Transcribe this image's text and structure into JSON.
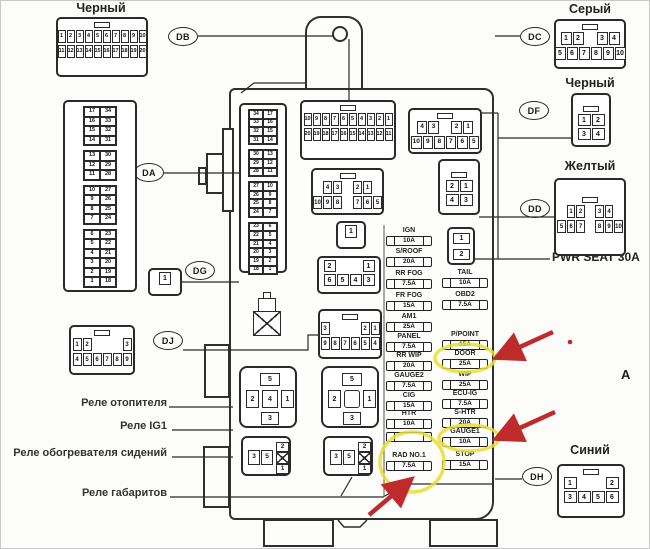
{
  "titles": {
    "top_left_connector": "Черный",
    "dc_connector": "Серый",
    "df_connector": "Черный",
    "dd_connector": "Желтый",
    "dh_connector": "Синий"
  },
  "labels": {
    "pwr_seat": "PWR SEAT 30A",
    "relay_heater": "Реле отопителя",
    "relay_ig1": "Реле IG1",
    "relay_seat_heater": "Реле обогревателя сидений",
    "relay_clearance_lights": "Реле габаритов",
    "letter_a": "A"
  },
  "ovals": {
    "db": "DB",
    "da": "DA",
    "dg": "DG",
    "dj": "DJ",
    "dc": "DC",
    "df": "DF",
    "dd": "DD",
    "dh": "DH"
  },
  "connectors": {
    "db_out": {
      "rows": [
        [
          "1",
          "2",
          "3",
          "4",
          "5",
          "6",
          "7",
          "8",
          "9",
          "10"
        ],
        [
          "11",
          "12",
          "13",
          "14",
          "15",
          "16",
          "17",
          "18",
          "19",
          "20"
        ]
      ]
    },
    "db_in": {
      "rows": [
        [
          "10",
          "9",
          "8",
          "7",
          "6",
          "5",
          "4",
          "3",
          "2",
          "1"
        ],
        [
          "20",
          "19",
          "18",
          "17",
          "16",
          "15",
          "14",
          "13",
          "12",
          "11"
        ]
      ]
    },
    "da_out": {
      "groups": [
        [
          [
            "17",
            "34"
          ],
          [
            "16",
            "33"
          ],
          [
            "15",
            "32"
          ],
          [
            "14",
            "31"
          ]
        ],
        [
          [
            "13",
            "30"
          ],
          [
            "12",
            "29"
          ],
          [
            "11",
            "28"
          ]
        ],
        [
          [
            "10",
            "27"
          ],
          [
            "9",
            "26"
          ],
          [
            "8",
            "25"
          ],
          [
            "7",
            "24"
          ]
        ],
        [
          [
            "6",
            "23"
          ],
          [
            "5",
            "22"
          ],
          [
            "4",
            "21"
          ],
          [
            "3",
            "20"
          ],
          [
            "2",
            "19"
          ],
          [
            "1",
            "18"
          ]
        ]
      ]
    },
    "da_in": {
      "groups": [
        [
          [
            "34",
            "17"
          ],
          [
            "33",
            "16"
          ],
          [
            "32",
            "15"
          ],
          [
            "31",
            "14"
          ]
        ],
        [
          [
            "30",
            "13"
          ],
          [
            "29",
            "12"
          ],
          [
            "28",
            "11"
          ]
        ],
        [
          [
            "27",
            "10"
          ],
          [
            "26",
            "9"
          ],
          [
            "25",
            "8"
          ],
          [
            "24",
            "7"
          ]
        ],
        [
          [
            "23",
            "6"
          ],
          [
            "22",
            "5"
          ],
          [
            "21",
            "4"
          ],
          [
            "20",
            "3"
          ],
          [
            "19",
            "2"
          ],
          [
            "18",
            "1"
          ]
        ]
      ]
    },
    "dg_out": {
      "rows": [
        [
          "1"
        ]
      ]
    },
    "dg_in": {
      "rows": [
        [
          "1"
        ]
      ]
    },
    "dj_out": {
      "rows": [
        [
          "1",
          "2",
          "",
          "",
          "",
          "3"
        ],
        [
          "4",
          "5",
          "6",
          "7",
          "8",
          "9"
        ]
      ]
    },
    "dj_in": {
      "rows": [
        [
          "3",
          "",
          "",
          "",
          "2",
          "1"
        ],
        [
          "9",
          "8",
          "7",
          "6",
          "5",
          "4"
        ]
      ]
    },
    "dc_out": {
      "rows": [
        [
          "1",
          "2",
          "",
          "3",
          "4"
        ],
        [
          "5",
          "6",
          "7",
          "8",
          "9",
          "10"
        ]
      ]
    },
    "dc_in": {
      "rows": [
        [
          "4",
          "3",
          "",
          "2",
          "1"
        ],
        [
          "10",
          "9",
          "8",
          "7",
          "6",
          "5"
        ]
      ]
    },
    "df_out": {
      "rows": [
        [
          "1",
          "2"
        ],
        [
          "3",
          "4"
        ]
      ]
    },
    "df_in": {
      "rows": [
        [
          "2",
          "1"
        ],
        [
          "4",
          "3"
        ]
      ]
    },
    "dd_out": {
      "rows": [
        [
          "1",
          "2",
          "",
          "3",
          "4"
        ],
        [
          "5",
          "6",
          "7",
          "",
          "8",
          "9",
          "10"
        ]
      ]
    },
    "dd_in": {
      "rows": [
        [
          "4",
          "3",
          "",
          "2",
          "1"
        ],
        [
          "10",
          "9",
          "8",
          "",
          "7",
          "6",
          "5"
        ]
      ]
    },
    "dh_out": {
      "rows": [
        [
          "1",
          "",
          "",
          "2"
        ],
        [
          "3",
          "4",
          "5",
          "6"
        ]
      ]
    },
    "dh_in": {
      "rows": [
        [
          "2",
          "",
          "",
          "1"
        ],
        [
          "6",
          "5",
          "4",
          "3"
        ]
      ]
    }
  },
  "fusebox": {
    "left_column": [
      {
        "label": "IGN",
        "amp": "10A"
      },
      {
        "label": "S/ROOF",
        "amp": "20A"
      },
      {
        "label": "RR FOG",
        "amp": "7.5A"
      },
      {
        "label": "FR FOG",
        "amp": "15A"
      },
      {
        "label": "AM1",
        "amp": "25A"
      },
      {
        "label": "PANEL",
        "amp": "7.5A"
      },
      {
        "label": "RR WIP",
        "amp": "20A"
      },
      {
        "label": "GAUGE2",
        "amp": "7.5A"
      },
      {
        "label": "CIG",
        "amp": "15A"
      },
      {
        "label": "HTR",
        "amp": "10A"
      },
      {
        "label": "",
        "amp": ""
      },
      {
        "label": "RAD NO.1",
        "amp": "7.5A"
      }
    ],
    "right_column": [
      {
        "label": "TAIL",
        "amp": "10A"
      },
      {
        "label": "OBD2",
        "amp": "7.5A"
      },
      {
        "label": "P/POINT",
        "amp": "15A"
      },
      {
        "label": "DOOR",
        "amp": "25A"
      },
      {
        "label": "WIP",
        "amp": "25A"
      },
      {
        "label": "ECU-IG",
        "amp": "7.5A"
      },
      {
        "label": "S-HTR",
        "amp": "20A"
      },
      {
        "label": "GAUGE1",
        "amp": "10A"
      },
      {
        "label": "STOP",
        "amp": "15A"
      }
    ],
    "pwr_seat_slots": [
      "1",
      "2"
    ]
  },
  "relays": {
    "cross_1": {
      "top": "5",
      "left": "2",
      "center": "4",
      "right": "1",
      "bottom": "3"
    },
    "cross_2": {
      "top": "5",
      "left": "2",
      "center": "",
      "right": "1",
      "bottom": "3"
    },
    "micro_1": {
      "cells": [
        "3",
        "5"
      ],
      "column": [
        "2",
        "x",
        "1"
      ]
    },
    "micro_2": {
      "cells": [
        "3",
        "5"
      ],
      "column": [
        "2",
        "x",
        "1"
      ]
    }
  },
  "highlights": {
    "circled_fuses": [
      "DOOR 25A",
      "GAUGE1 10A",
      "RAD NO.1 7.5A"
    ]
  },
  "colors": {
    "highlight_yellow": "#e8de34",
    "arrow_red": "#bf2b2b",
    "line": "#2a2a2a"
  }
}
